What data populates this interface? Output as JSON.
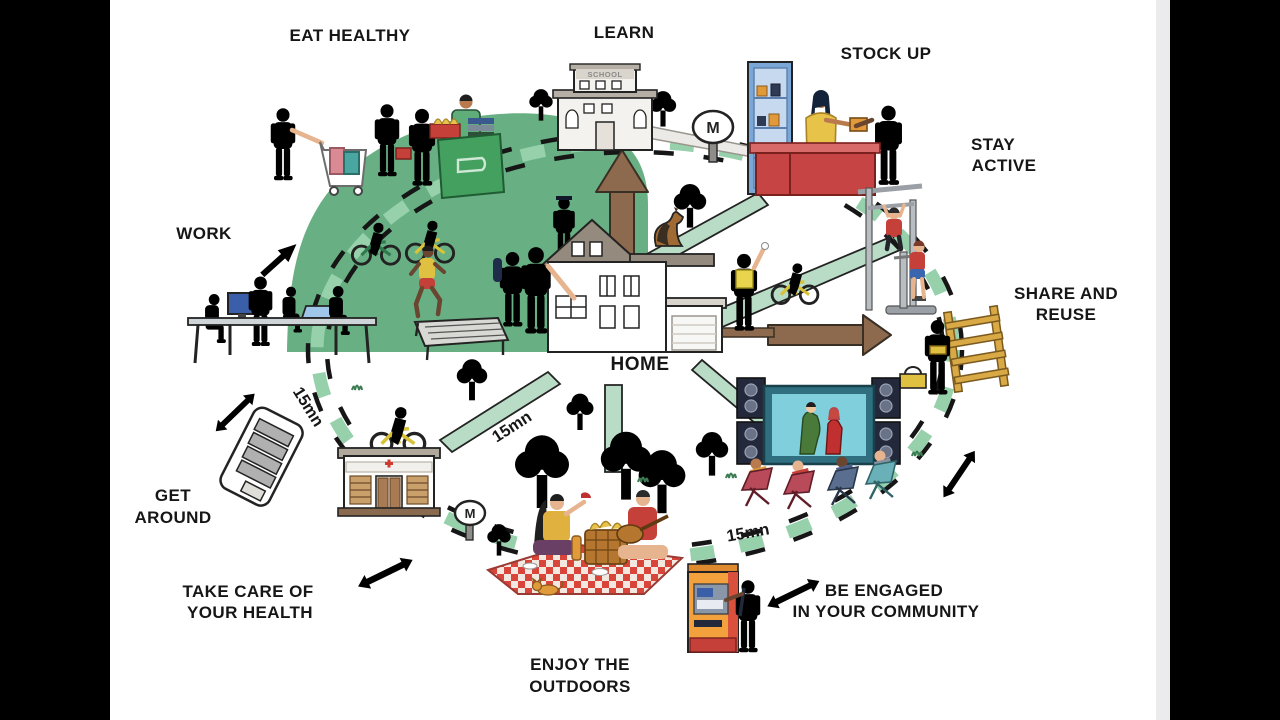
{
  "labels": {
    "eat_healthy": "EAT HEALTHY",
    "learn": "LEARN",
    "stock_up": "STOCK UP",
    "stay_active_line1": "STAY",
    "stay_active_line2": "ACTIVE",
    "share_reuse_line1": "SHARE AND",
    "share_reuse_line2": "REUSE",
    "work": "WORK",
    "get_around_line1": "GET",
    "get_around_line2": "AROUND",
    "health_line1": "TAKE CARE OF",
    "health_line2": "YOUR HEALTH",
    "outdoors_line1": "ENJOY THE",
    "outdoors_line2": "OUTDOORS",
    "community_line1": "BE ENGAGED",
    "community_line2": "IN YOUR COMMUNITY",
    "home": "HOME",
    "travel_time": "15mn",
    "school_sign": "SCHOOL",
    "metro_sign": "M"
  },
  "colors": {
    "background": "#ffffff",
    "letterbox": "#000000",
    "park_green": "#68b083",
    "road_green": "#b9dcc6",
    "ring_green": "#96d1ab",
    "label_text": "#161616",
    "arrow_brown": "#8d6a4d",
    "counter_red": "#c64444",
    "shelf_blue": "#7ba7d7",
    "screen_teal": "#7fd0dc",
    "atm_orange": "#f2a13c",
    "wood_yellow": "#d8a945",
    "cross_red": "#d03a2e"
  }
}
